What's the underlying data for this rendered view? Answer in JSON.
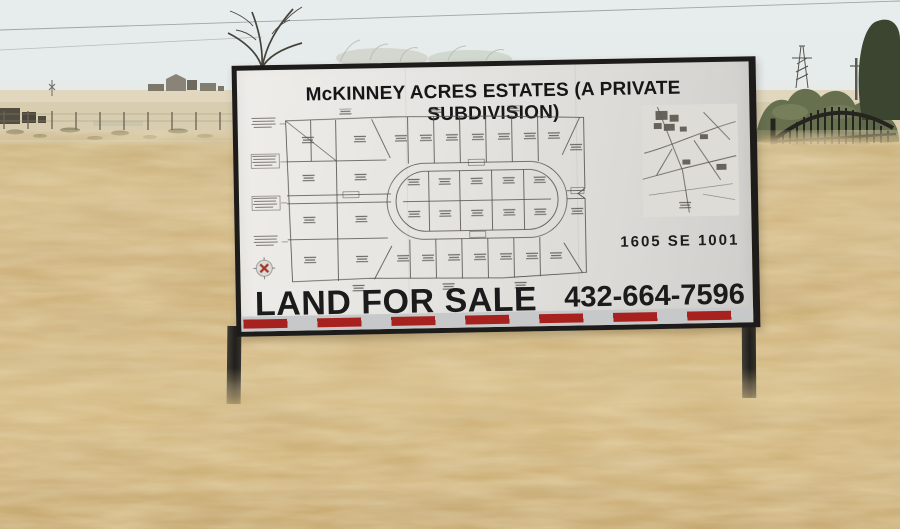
{
  "sign": {
    "title": "McKINNEY ACRES ESTATES (A PRIVATE SUBDIVISION)",
    "address": "1605 SE 1001",
    "sale_label": "LAND FOR SALE",
    "phone": "432-664-7596",
    "colors": {
      "board": "#e6e5e1",
      "frame": "#1d1c1a",
      "text": "#171717",
      "stripe_silver": "#c6c8c9",
      "stripe_red": "#a7221f",
      "compass_red": "#a93528"
    }
  },
  "scene": {
    "sky_color": "#e4e9e8",
    "grass_color": "#cfb37d",
    "shrub_color": "#66704f"
  }
}
